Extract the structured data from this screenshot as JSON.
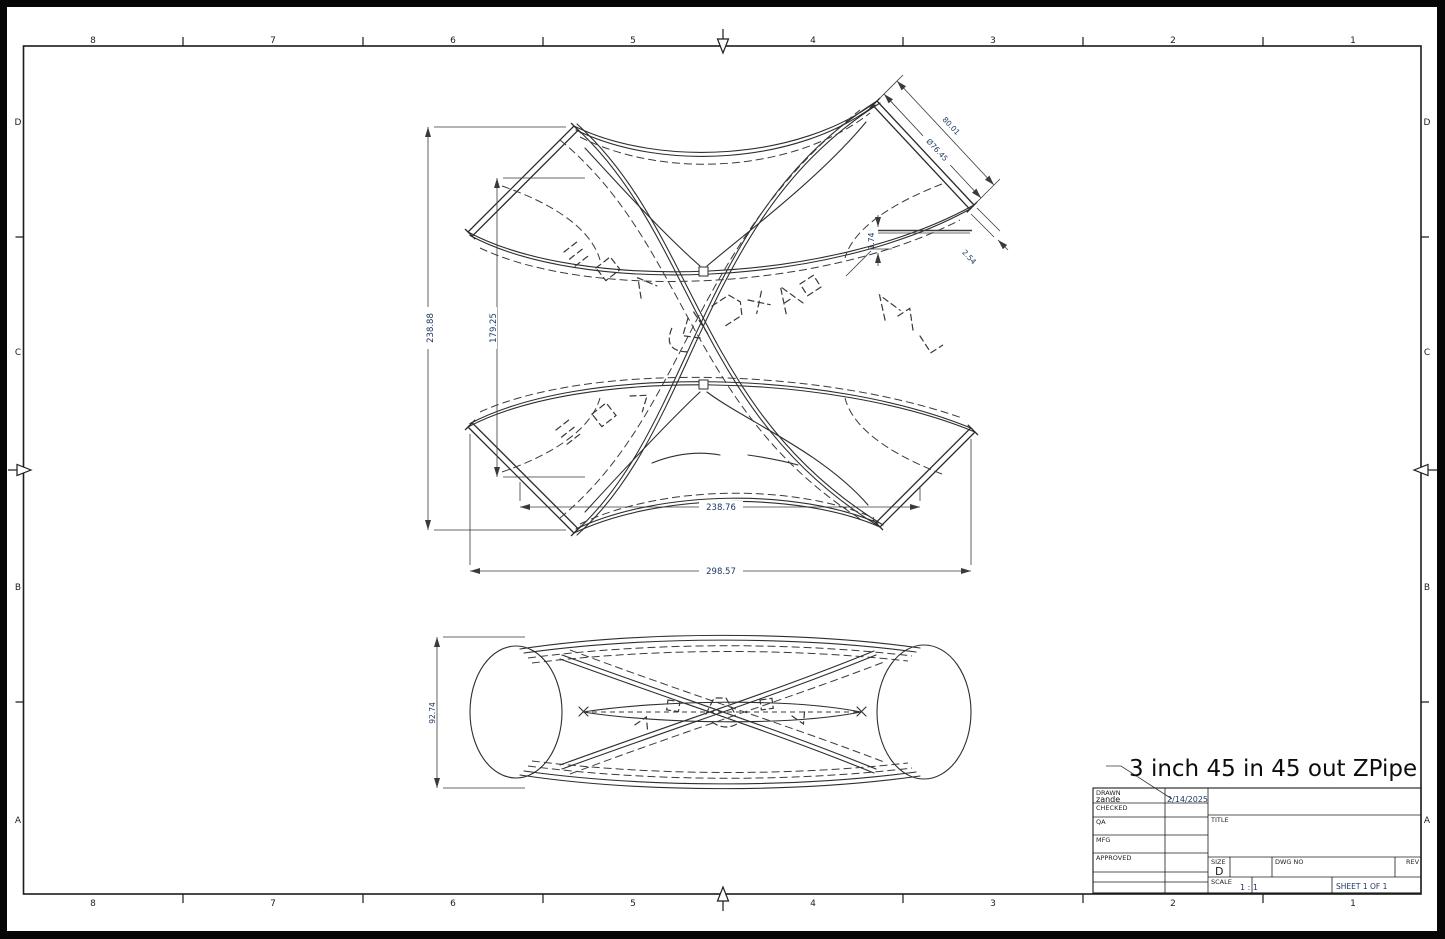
{
  "colors": {
    "sheet_background": "#ffffff",
    "outside_frame": "#060606",
    "line_color": "#2e2e2e",
    "dimension_text": "#1f3864"
  },
  "annotation": {
    "part_name": "3 inch 45 in 45 out ZPipe"
  },
  "zones": {
    "top": [
      "8",
      "7",
      "6",
      "5",
      "4",
      "3",
      "2",
      "1"
    ],
    "bottom": [
      "8",
      "7",
      "6",
      "5",
      "4",
      "3",
      "2",
      "1"
    ],
    "left": [
      "D",
      "C",
      "B",
      "A"
    ],
    "right": [
      "D",
      "C",
      "B",
      "A"
    ]
  },
  "dimensions": {
    "overall_height": "238.88",
    "inner_height": "179.25",
    "inner_width": "238.76",
    "overall_width": "298.57",
    "port_length": "80.01",
    "port_diameter": "Ø76.45",
    "wall_offset": "1.74",
    "wall_thickness": "2.54",
    "side_height": "92.74"
  },
  "title_block": {
    "rows": [
      {
        "label": "DRAWN",
        "value": "zande",
        "date": "2/14/2025"
      },
      {
        "label": "CHECKED",
        "value": "",
        "date": ""
      },
      {
        "label": "QA",
        "value": "",
        "date": ""
      },
      {
        "label": "MFG",
        "value": "",
        "date": ""
      },
      {
        "label": "APPROVED",
        "value": "",
        "date": ""
      }
    ],
    "title_label": "TITLE",
    "size_label": "SIZE",
    "size_value": "D",
    "dwg_no_label": "DWG NO",
    "rev_label": "REV",
    "scale_label": "SCALE",
    "scale_value": "1 : 1",
    "sheet_text": "SHEET 1  OF 1"
  }
}
